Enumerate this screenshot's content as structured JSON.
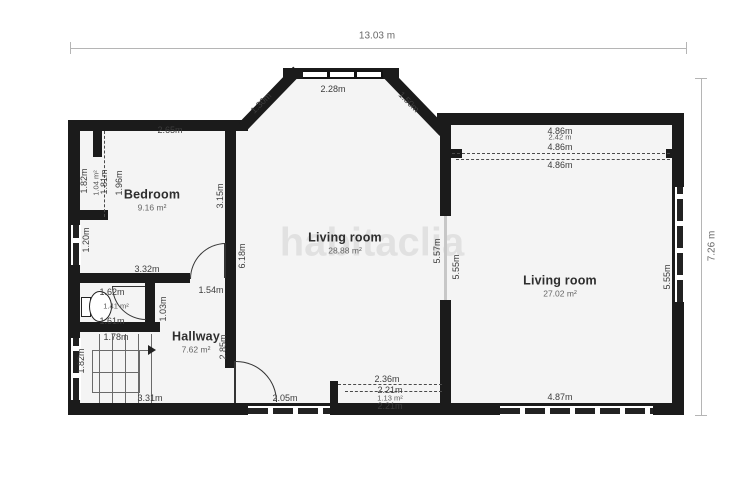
{
  "watermark": "habitaclia",
  "overall_dimensions": {
    "width": "13.03 m",
    "height": "7.26 m"
  },
  "colors": {
    "wall": "#1b1b1b",
    "floor": "#f4f4f4",
    "dimension_line": "#b5b5b5",
    "label_text": "#3c3c3c",
    "watermark": "#ebebeb"
  },
  "rooms": [
    {
      "name": "Bedroom",
      "area": "9.16 m²",
      "x": 152,
      "y": 200
    },
    {
      "name": "Living room",
      "area": "28.88 m²",
      "x": 345,
      "y": 243
    },
    {
      "name": "Living room",
      "area": "27.02 m²",
      "x": 560,
      "y": 286
    },
    {
      "name": "Hallway",
      "area": "7.62 m²",
      "x": 196,
      "y": 342
    }
  ],
  "labels": [
    {
      "text": "13.03 m",
      "x": 377,
      "y": 36,
      "rot": 0,
      "cls": "dim-big"
    },
    {
      "text": "7.26 m",
      "x": 712,
      "y": 246,
      "rot": -90,
      "cls": "dim-big"
    },
    {
      "text": "2.65m",
      "x": 170,
      "y": 130,
      "rot": 0,
      "cls": "dim"
    },
    {
      "text": "1.30m",
      "x": 261,
      "y": 103,
      "rot": -45,
      "cls": "dim"
    },
    {
      "text": "2.28m",
      "x": 333,
      "y": 89,
      "rot": 0,
      "cls": "dim"
    },
    {
      "text": "1.50m",
      "x": 409,
      "y": 102,
      "rot": 45,
      "cls": "dim"
    },
    {
      "text": "4.86m",
      "x": 560,
      "y": 131,
      "rot": 0,
      "cls": "dim"
    },
    {
      "text": "2.42 m",
      "x": 560,
      "y": 137,
      "rot": 0,
      "cls": "dim-small"
    },
    {
      "text": "4.86m",
      "x": 560,
      "y": 147,
      "rot": 0,
      "cls": "dim"
    },
    {
      "text": "4.86m",
      "x": 560,
      "y": 165,
      "rot": 0,
      "cls": "dim"
    },
    {
      "text": "1.82m",
      "x": 84,
      "y": 181,
      "rot": -90,
      "cls": "dim"
    },
    {
      "text": "1.04 m²",
      "x": 96,
      "y": 183,
      "rot": -90,
      "cls": "dim-small"
    },
    {
      "text": "1.81m",
      "x": 104,
      "y": 182,
      "rot": -90,
      "cls": "dim"
    },
    {
      "text": "1.96m",
      "x": 119,
      "y": 183,
      "rot": -90,
      "cls": "dim"
    },
    {
      "text": "3.15m",
      "x": 220,
      "y": 196,
      "rot": -90,
      "cls": "dim"
    },
    {
      "text": "1.20m",
      "x": 86,
      "y": 240,
      "rot": -90,
      "cls": "dim"
    },
    {
      "text": "3.32m",
      "x": 147,
      "y": 269,
      "rot": 0,
      "cls": "dim"
    },
    {
      "text": "1.54m",
      "x": 211,
      "y": 290,
      "rot": 0,
      "cls": "dim"
    },
    {
      "text": "6.18m",
      "x": 242,
      "y": 256,
      "rot": -90,
      "cls": "dim"
    },
    {
      "text": "1.62m",
      "x": 112,
      "y": 292,
      "rot": 0,
      "cls": "dim"
    },
    {
      "text": "1.41 m²",
      "x": 116,
      "y": 306,
      "rot": 0,
      "cls": "dim-small"
    },
    {
      "text": "1.61m",
      "x": 112,
      "y": 321,
      "rot": 0,
      "cls": "dim"
    },
    {
      "text": "1.03m",
      "x": 163,
      "y": 309,
      "rot": -90,
      "cls": "dim"
    },
    {
      "text": "1.78m",
      "x": 116,
      "y": 337,
      "rot": 0,
      "cls": "dim"
    },
    {
      "text": "2.85m",
      "x": 223,
      "y": 347,
      "rot": -90,
      "cls": "dim"
    },
    {
      "text": "1.82m",
      "x": 81,
      "y": 361,
      "rot": -90,
      "cls": "dim"
    },
    {
      "text": "3.31m",
      "x": 150,
      "y": 398,
      "rot": 0,
      "cls": "dim"
    },
    {
      "text": "2.05m",
      "x": 285,
      "y": 398,
      "rot": 0,
      "cls": "dim"
    },
    {
      "text": "5.57m",
      "x": 437,
      "y": 251,
      "rot": -90,
      "cls": "dim"
    },
    {
      "text": "5.55m",
      "x": 456,
      "y": 267,
      "rot": -90,
      "cls": "dim"
    },
    {
      "text": "5.55m",
      "x": 667,
      "y": 277,
      "rot": -90,
      "cls": "dim"
    },
    {
      "text": "2.36m",
      "x": 387,
      "y": 379,
      "rot": 0,
      "cls": "dim"
    },
    {
      "text": "2.21m",
      "x": 390,
      "y": 390,
      "rot": 0,
      "cls": "dim"
    },
    {
      "text": "1.13 m²",
      "x": 390,
      "y": 398,
      "rot": 0,
      "cls": "dim-small"
    },
    {
      "text": "2.21m",
      "x": 390,
      "y": 406,
      "rot": 0,
      "cls": "dim"
    },
    {
      "text": "4.87m",
      "x": 560,
      "y": 397,
      "rot": 0,
      "cls": "dim"
    }
  ]
}
